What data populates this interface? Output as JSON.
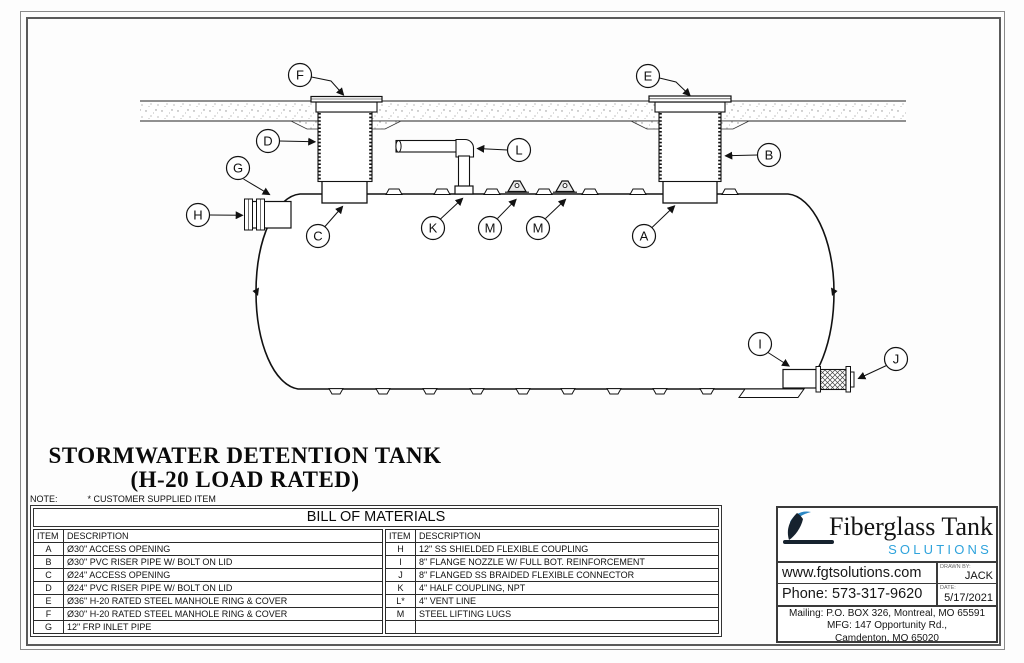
{
  "drawing": {
    "title_line1": "STORMWATER DETENTION TANK",
    "title_line2": "(H-20 LOAD RATED)",
    "note_label": "NOTE:",
    "note_text": "* CUSTOMER SUPPLIED ITEM",
    "callouts": [
      "F",
      "E",
      "D",
      "B",
      "L",
      "G",
      "H",
      "C",
      "K",
      "M",
      "M",
      "A",
      "I",
      "J"
    ]
  },
  "bom": {
    "title": "BILL OF MATERIALS",
    "col_item": "ITEM",
    "col_desc": "DESCRIPTION",
    "left_rows": [
      {
        "item": "A",
        "desc": "Ø30\" ACCESS OPENING"
      },
      {
        "item": "B",
        "desc": "Ø30\" PVC RISER PIPE W/ BOLT ON LID"
      },
      {
        "item": "C",
        "desc": "Ø24\" ACCESS OPENING"
      },
      {
        "item": "D",
        "desc": "Ø24\" PVC RISER PIPE W/ BOLT ON LID"
      },
      {
        "item": "E",
        "desc": "Ø36\" H-20 RATED STEEL MANHOLE RING & COVER"
      },
      {
        "item": "F",
        "desc": "Ø30\" H-20 RATED STEEL MANHOLE RING & COVER"
      },
      {
        "item": "G",
        "desc": "12\" FRP INLET PIPE"
      }
    ],
    "right_rows": [
      {
        "item": "H",
        "desc": "12\" SS SHIELDED FLEXIBLE COUPLING"
      },
      {
        "item": "I",
        "desc": "8\" FLANGE NOZZLE W/ FULL BOT. REINFORCEMENT"
      },
      {
        "item": "J",
        "desc": "8\" FLANGED SS BRAIDED FLEXIBLE CONNECTOR"
      },
      {
        "item": "K",
        "desc": "4\" HALF COUPLING, NPT"
      },
      {
        "item": "L*",
        "desc": "4\" VENT LINE"
      },
      {
        "item": "M",
        "desc": "STEEL LIFTING LUGS"
      },
      {
        "item": "",
        "desc": ""
      }
    ]
  },
  "title_block": {
    "company_name": "Fiberglass Tank",
    "company_sub": "SOLUTIONS",
    "website": "www.fgtsolutions.com",
    "phone": "Phone: 573-317-9620",
    "drawn_by_label": "DRAWN BY:",
    "drawn_by": "JACK",
    "date_label": "DATE:",
    "date": "5/17/2021",
    "address_line1": "Mailing: P.O. BOX 326, Montreal, MO 65591",
    "address_line2": "MFG: 147 Opportunity Rd.,",
    "address_line3": "Camdenton, MO 65020",
    "accent_color": "#2fa3dc"
  }
}
